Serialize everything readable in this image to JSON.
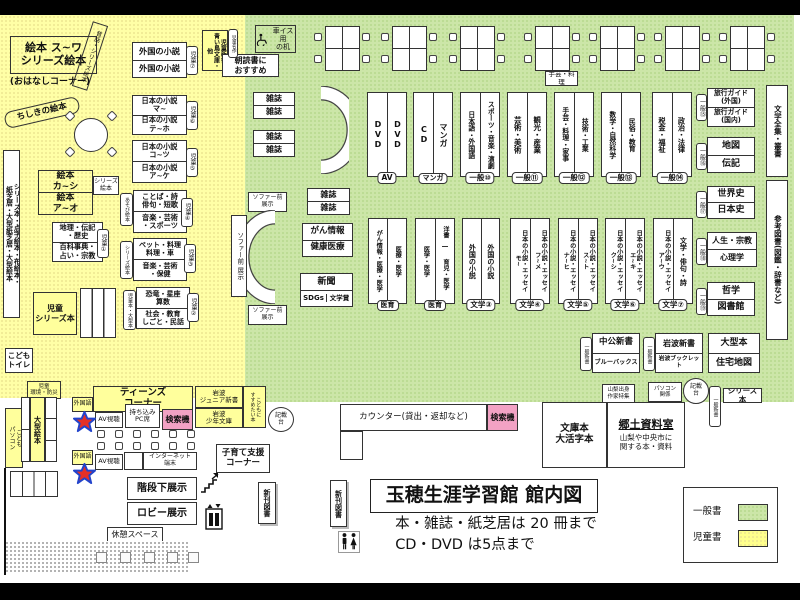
{
  "colors": {
    "area_yellow": "#ffffa6",
    "area_green": "#cce6a8",
    "pink": "#f2a2c4",
    "star_red": "#e53026",
    "star_blue": "#2244cc"
  },
  "kids": {
    "ehon_suwa": "絵本 ス~ワ\nシリーズ絵本",
    "mukashi": "昔話・シリーズ絵本",
    "ohanashi": "(おはなしコーナー)",
    "chishiki": "ちしきの絵本",
    "ehon_kashi": "絵本\nカ~シ",
    "ehon_ao": "絵本\nア~オ",
    "series_ehon_sm": "シリーズ\n絵本",
    "left_tall": "シリーズ本・点字絵本・布絵本・\n紙芝居・大型紙芝居・大型絵本",
    "chiri_top": "地理・伝記\n・歴史",
    "chiri_bot": "百科事典・\n占い・宗教",
    "tag1": "児童①",
    "gaikoku": "外国の小説",
    "tag7": "児童⑦",
    "nihon6_top": "日本の小説\nマ~",
    "nihon6_bot": "日本の小説\nテ~ホ",
    "tag6": "児童⑥",
    "nihon5_top": "日本の小説\nコ~ツ",
    "nihon5_bot": "日本の小説\nア~ケ",
    "tag5": "児童⑤",
    "kotoba_top": "ことば・詩\n俳句・短歌",
    "kotoba_bot": "音楽・芸術\n・スポーツ",
    "tag4": "児童④",
    "tag_asobi": "あそび絵本",
    "pet_top": "ペット・料理\n料理・車",
    "pet_bot": "音楽・芸術\n・保健",
    "tag3": "児童③",
    "tag_series": "シリーズ絵本",
    "kyoryu_top": "恐竜・星座\n算数",
    "kyoryu_bot": "社会・教育\nしごと・民話",
    "tag2": "児童②",
    "tag_oogata": "児童本・大型本",
    "jido_series": "児童\nシリーズ本",
    "toilet": "こども\nトイレ",
    "kankyo": "児童\n環境・防災",
    "jido_shinsho": "児童新書\n青い鳥文庫・他",
    "meisaku": "児童名作",
    "asadoku": "朝読書に\nおすすめ",
    "oogata_ehon": "大型絵本",
    "kodomo_pc": "こども\nパソコン"
  },
  "top": {
    "wheelchair_desk": "車イス用\nの机",
    "shugei_tag": "手芸・料理"
  },
  "row1": {
    "av": {
      "l": "DVD",
      "r": "DVD",
      "tag": "AV"
    },
    "manga": {
      "l": "CD",
      "r": "マンガ",
      "tag": "マンガ"
    },
    "g10": {
      "l": "日本語・外国語",
      "r": "スポーツ・音楽・演劇",
      "tag": "一般⑩"
    },
    "g11": {
      "l": "芸術・美術",
      "r": "観光・産業",
      "tag": "一般⑪"
    },
    "g12": {
      "l": "手芸・料理・家事",
      "r": "技術・工業",
      "tag": "一般⑫"
    },
    "g13": {
      "l": "数学・自然科学",
      "r": "民俗・教育",
      "tag": "一般⑬"
    },
    "g14": {
      "l": "税金・福祉",
      "r": "政治・法律",
      "tag": "一般⑭"
    },
    "g15": {
      "top": "旅行ガイド\n(外国)",
      "bot": "旅行ガイド\n(国内)",
      "tag": "一般⑮"
    },
    "g16": {
      "top": "地図",
      "bot": "伝記",
      "tag": "一般⑯"
    },
    "g17": {
      "top": "世界史",
      "bot": "日本史",
      "tag": "一般⑰"
    },
    "g18": {
      "top": "人生・宗教",
      "bot": "心理学",
      "tag": "一般⑱"
    },
    "g19": {
      "top": "哲学",
      "bot": "図書館",
      "tag": "一般⑲"
    },
    "zenshu": "文学全集・叢書",
    "sanko": "参考図書(図鑑・辞書など)"
  },
  "row2": {
    "i1": {
      "l": "がん情報・医療・医学",
      "r": "医療・医学",
      "tag": "医育"
    },
    "i2": {
      "l": "医学・医学",
      "r_top": "洋書",
      "r_bot": "育児・医学",
      "tag": "医育"
    },
    "b3": {
      "l": "外国の小説",
      "r": "外国の小説",
      "tag": "文学③"
    },
    "b4": {
      "l": "日本の小説・エッセイ\nモ~",
      "r": "日本の小説・エッセイ\nフ~メ",
      "tag": "文学④"
    },
    "b5": {
      "l": "日本の小説・エッセイ\nナ~ヒ",
      "r": "日本の小説・エッセイ\nス~ト",
      "tag": "文学⑤"
    },
    "b6": {
      "l": "日本の小説・エッセイ\nク~シ",
      "r": "日本の小説・エッセイ\nエ~キ",
      "tag": "文学⑥"
    },
    "b7": {
      "l": "日本の小説・エッセイ\nア~ウ",
      "r": "文学・俳句・詩",
      "tag": "文学⑦"
    }
  },
  "sofa": {
    "zasshi": "雑誌",
    "sofa_mae": "ソファー前\n展示",
    "sofa_mae_v": "ソファー前 展示",
    "gan": "がん情報",
    "kenko": "健康医療",
    "shinbun": "新聞",
    "sdgs": "SDGs",
    "bungakusho": "文学賞"
  },
  "shinsho": {
    "ippan_shinsho": "一般新書",
    "chuko": "中公新書",
    "blue": "ブルーバックス",
    "iwanami": "岩波新書",
    "booklet": "岩波ブックレット",
    "oogata": "大型本",
    "jutaku": "住宅地図",
    "yamanashi": "山梨出身\n作家特集",
    "pc_kankei": "パソコン\n関係",
    "kisaidai": "記載\n台",
    "series_bon": "シリーズ本"
  },
  "local": {
    "bunko": "文庫本\n大活字本",
    "kyodo_title": "郷土資料室",
    "kyodo_body": "山梨や中央市に\n関する本・資料"
  },
  "counter": {
    "label": "カウンター(貸出・返却など)",
    "kensaku": "検索機",
    "kisaidai": "記載\n台"
  },
  "teens": {
    "title": "ティーンズ\nコーナー",
    "iwanami_jr": "岩波\nジュニア新書",
    "iwanami_shonen": "岩波\n少年文庫",
    "kodomoni": "こどもに\nすすめたい本",
    "gaikokugo": "外国語",
    "av": "AV視聴",
    "pc_seat": "持ち込み\nPC席",
    "kensaku": "検索機",
    "internet": "インターネット\n端末",
    "kosodate": "子育て支援\nコーナー",
    "kaidan": "階段下展示",
    "lobby": "ロビー展示",
    "kyukei": "休憩スペース",
    "shinkan": "新刊図書"
  },
  "footer": {
    "title": "玉穂生涯学習館 館内図",
    "rule1": "本・雑誌・紙芝居は 20 冊まで",
    "rule2": "CD・DVD は5点まで"
  },
  "legend": {
    "general": "一般書",
    "children": "児童書"
  }
}
